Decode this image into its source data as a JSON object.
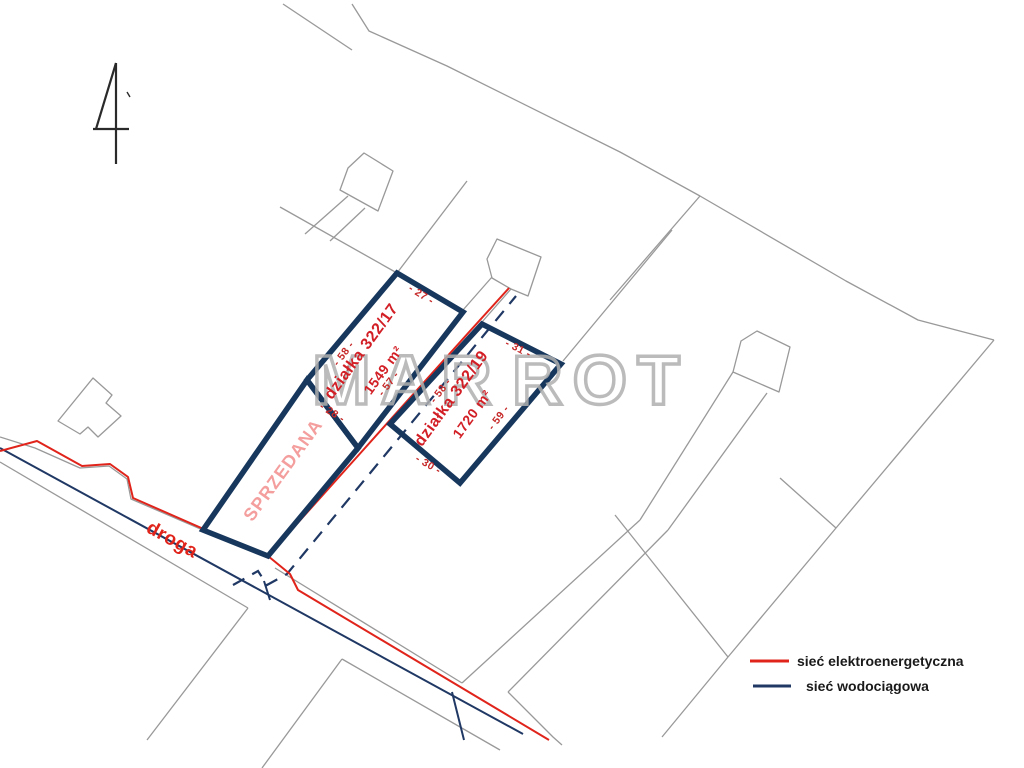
{
  "watermark": {
    "left": "MAR",
    "right": "ROT"
  },
  "road": {
    "label": "droga"
  },
  "plots": [
    {
      "name": "działka 322/17",
      "area": "1549 m²"
    },
    {
      "name": "działka 322/19",
      "area": "1720 m²"
    },
    {
      "status": "SPRZEDANA"
    }
  ],
  "dimensions": [
    {
      "label": "- 58 -"
    },
    {
      "label": "- 27 -"
    },
    {
      "label": "- 57 -"
    },
    {
      "label": "- 28 -"
    },
    {
      "label": "- 58 -"
    },
    {
      "label": "- 31 -"
    },
    {
      "label": "- 59 -"
    },
    {
      "label": "- 30 -"
    }
  ],
  "legend": {
    "items": [
      {
        "label": "sieć elektroenergetyczna",
        "color": "#e0241b"
      },
      {
        "label": "sieć wodociągowa",
        "color": "#1f3864"
      }
    ]
  },
  "colors": {
    "plot_border": "#17375d",
    "power_line": "#e0241b",
    "water_line": "#1f3864",
    "parcel_line": "#999999",
    "sold_text": "#f49e9e",
    "plot_text": "#d21f26",
    "dimension_text": "#c62828",
    "watermark": "#b0b0b0"
  }
}
